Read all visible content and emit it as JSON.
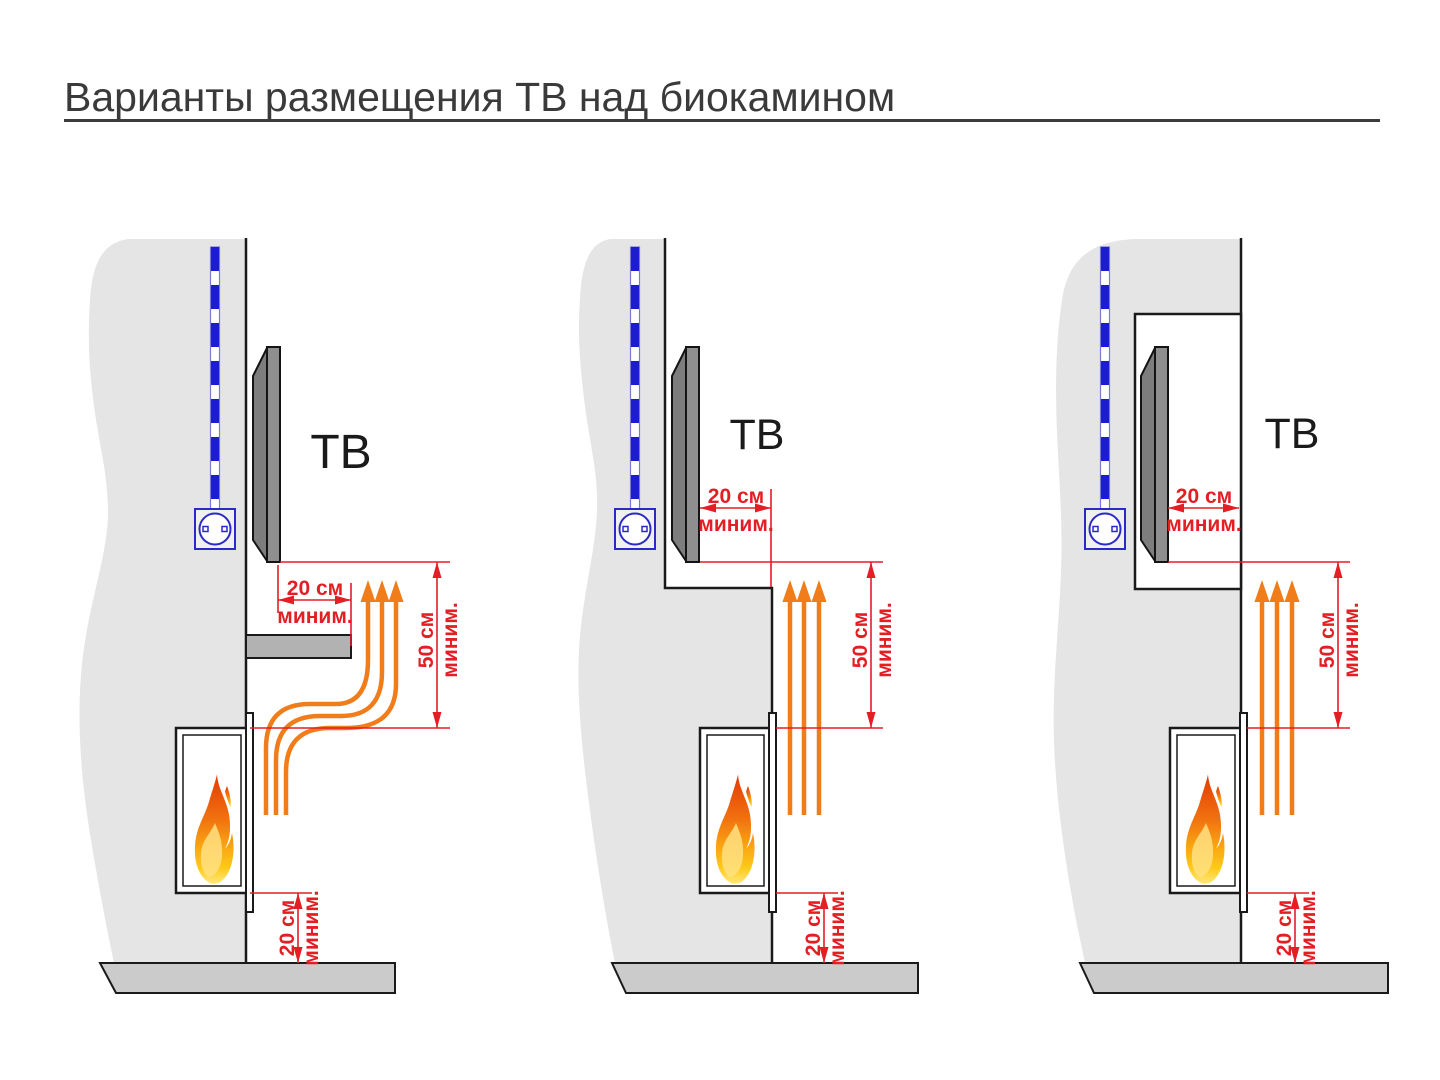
{
  "title": {
    "text": "Варианты размещения ТВ над биокамином"
  },
  "colors": {
    "dimension_red": "#e31e24",
    "heat_orange": "#f07c1a",
    "cable_blue": "#1c1cd0",
    "wall_gray": "#e5e5e5",
    "floor_gray": "#cbcbcb",
    "tv_gray": "#8f8f8f",
    "shelf_gray": "#b2b2b2",
    "outline_black": "#1a1a1a",
    "title_gray": "#3a3a3a"
  },
  "diagrams": [
    {
      "tv_label": "ТВ",
      "front_clearance": {
        "value": "20 см",
        "qualifier": "миним."
      },
      "vertical_clearance": {
        "value": "50 см",
        "qualifier": "миним."
      },
      "floor_clearance": {
        "value": "20 см",
        "qualifier": "миним."
      }
    },
    {
      "tv_label": "ТВ",
      "front_clearance": {
        "value": "20 см",
        "qualifier": "миним."
      },
      "vertical_clearance": {
        "value": "50 см",
        "qualifier": "миним."
      },
      "floor_clearance": {
        "value": "20 см",
        "qualifier": "миним."
      }
    },
    {
      "tv_label": "ТВ",
      "front_clearance": {
        "value": "20 см",
        "qualifier": "миним."
      },
      "vertical_clearance": {
        "value": "50 см",
        "qualifier": "миним."
      },
      "floor_clearance": {
        "value": "20 см",
        "qualifier": "миним."
      }
    }
  ]
}
